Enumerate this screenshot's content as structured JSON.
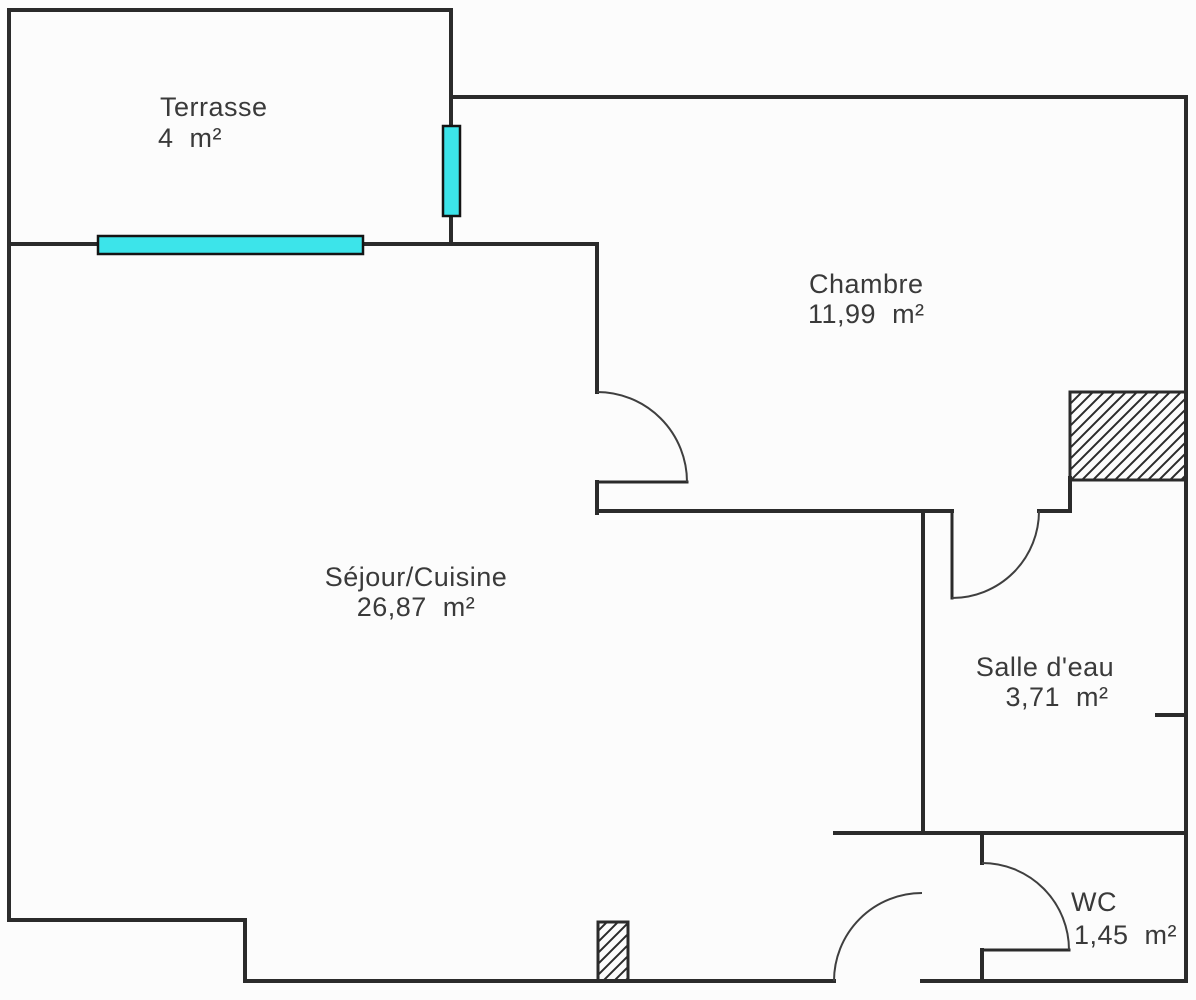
{
  "document": {
    "type": "floor-plan"
  },
  "colors": {
    "wall": "#2b2b2b",
    "door_arc": "#3f3f3f",
    "window_fill": "#3ce4ea",
    "window_border": "#141414",
    "text": "#3a3a3a",
    "background": "#fcfcfc"
  },
  "rooms": [
    {
      "name": "Terrasse",
      "area": "4  m²"
    },
    {
      "name": "Chambre",
      "area": "11,99  m²"
    },
    {
      "name": "Séjour/Cuisine",
      "area": "26,87  m²"
    },
    {
      "name": "Salle d'eau",
      "area": "3,71  m²"
    },
    {
      "name": "WC",
      "area": "1,45  m²"
    }
  ],
  "features": {
    "windows": [
      "terrace-window-horizontal",
      "terrace-window-vertical"
    ],
    "doors": [
      "chambre-door",
      "salle-deau-door",
      "wc-door",
      "entrance-door"
    ],
    "shafts": [
      "duct-shaft-top-right",
      "duct-pillar-bottom"
    ]
  }
}
